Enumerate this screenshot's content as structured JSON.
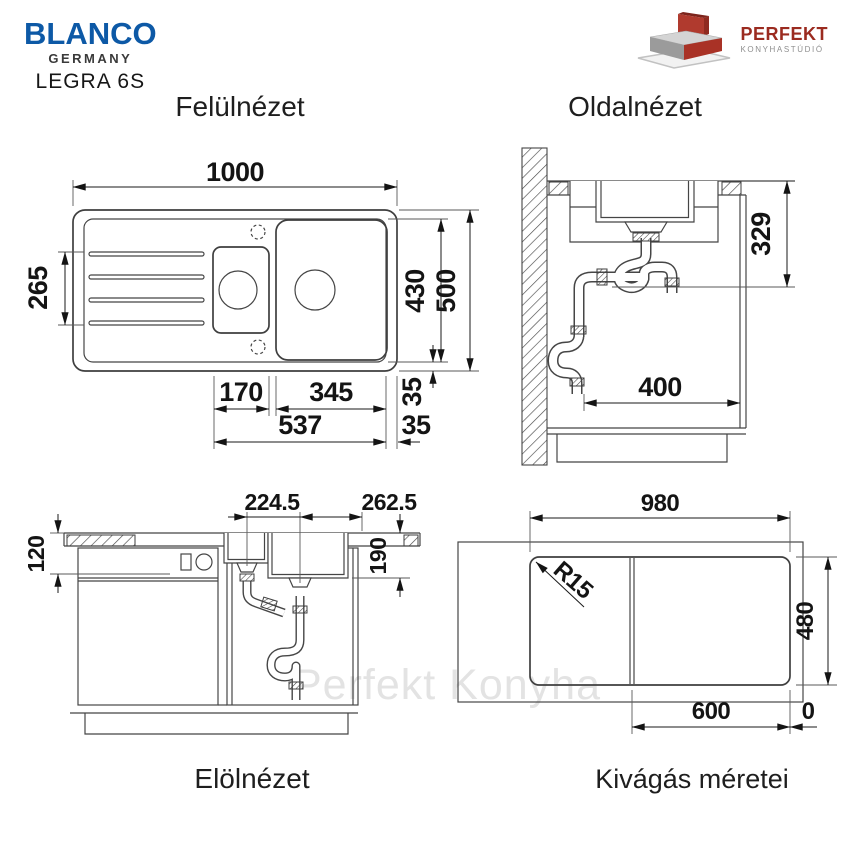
{
  "header": {
    "brand": "BLANCO",
    "brand_country": "GERMANY",
    "model": "LEGRA 6S",
    "studio_name": "PERFEKT",
    "studio_subtitle": "KONYHASTÚDIÓ"
  },
  "watermark": "Perfekt Konyha",
  "views": {
    "top": {
      "title": "Felülnézet",
      "dims": {
        "overall_width": "1000",
        "drainer_depth": "265",
        "bowl_zone_depth": "430",
        "overall_depth": "500",
        "small_bowl_width": "170",
        "main_bowl_width": "345",
        "bowls_span": "537",
        "rim_right": "35",
        "rim_bottom": "35"
      }
    },
    "side": {
      "title": "Oldalnézet",
      "dims": {
        "install_depth": "329",
        "front_clearance": "400"
      }
    },
    "front": {
      "title": "Elölnézet",
      "dims": {
        "small_drain_offset": "224.5",
        "main_drain_offset": "262.5",
        "front_height": "120",
        "bowl_depth": "190"
      }
    },
    "cutout": {
      "title": "Kivágás méretei",
      "dims": {
        "width": "980",
        "depth": "480",
        "right_section": "600",
        "edge_offset": "0",
        "corner_radius": "R15"
      }
    }
  },
  "colors": {
    "brand_blue": "#0d59a6",
    "logo_red": "#9b2b20",
    "line": "#454545",
    "dim_text": "#141414",
    "watermark": "#e3e3e3"
  }
}
